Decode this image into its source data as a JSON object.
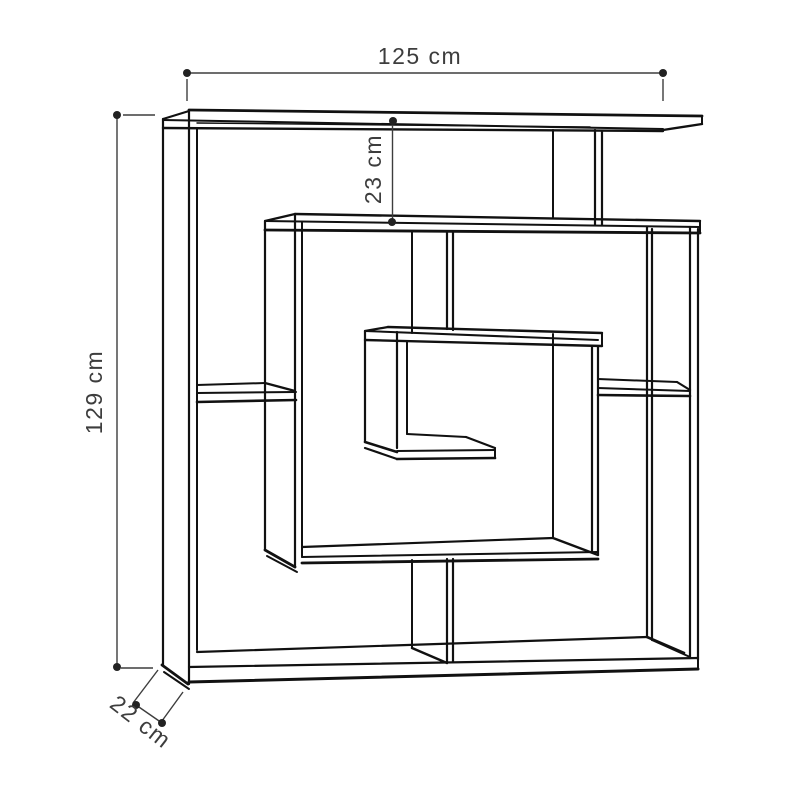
{
  "diagram": {
    "kind": "furniture-dimension-drawing",
    "unit": "cm"
  },
  "annotations": {
    "width_label": "125 cm",
    "height_label": "129 cm",
    "top_gap_label": "23 cm",
    "depth_label": "22 cm"
  },
  "colors": {
    "background": "#ffffff",
    "outline": "#111111",
    "dimension_line": "#3d3d3d",
    "dimension_text": "#3d3d3d"
  }
}
